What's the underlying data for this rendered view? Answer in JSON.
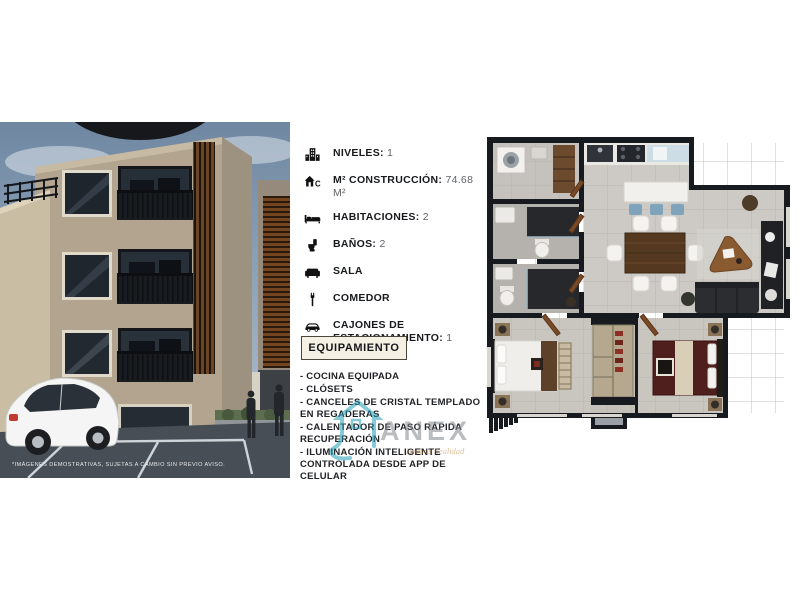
{
  "building_photo": {
    "disclaimer": "*IMÁGENES DEMOSTRATIVAS, SUJETAS A CAMBIO SIN PREVIO AVISO."
  },
  "features": {
    "items": [
      {
        "icon": "levels-building-icon",
        "label": "NIVELES:",
        "value": "1"
      },
      {
        "icon": "construction-house-icon",
        "label": "M² CONSTRUCCIÓN:",
        "value": "74.68 M²"
      },
      {
        "icon": "bed-icon",
        "label": "HABITACIONES:",
        "value": "2"
      },
      {
        "icon": "bath-icon",
        "label": "BAÑOS:",
        "value": "2"
      },
      {
        "icon": "sofa-icon",
        "label": "SALA",
        "value": ""
      },
      {
        "icon": "dining-icon",
        "label": "COMEDOR",
        "value": ""
      },
      {
        "icon": "car-icon",
        "label": "CAJONES DE ESTACIONAMIENTO:",
        "value": "1"
      }
    ]
  },
  "equipamiento": {
    "title": "EQUIPAMIENTO",
    "items": [
      "- COCINA EQUIPADA",
      "- CLÓSETS",
      "- CANCELES DE CRISTAL TEMPLADO EN REGADERAS",
      "- CALENTADOR DE PASO RÁPIDA RECUPERACIÓN",
      "- ILUMINACIÓN INTELIGENTE CONTROLADA DESDE APP DE CELULAR"
    ]
  },
  "watermark": {
    "brand": "ANEX",
    "tagline": "Hechos Realidad",
    "accent_color": "#249fb7",
    "brand_color": "#82888d",
    "tagline_color": "#c28949"
  },
  "colors": {
    "facade": "#b2a48e",
    "plan_wall": "#171a1f",
    "plan_floor": "#cdcac5",
    "equip_border": "#4a463c",
    "equip_bg": "#f4f0e4"
  }
}
